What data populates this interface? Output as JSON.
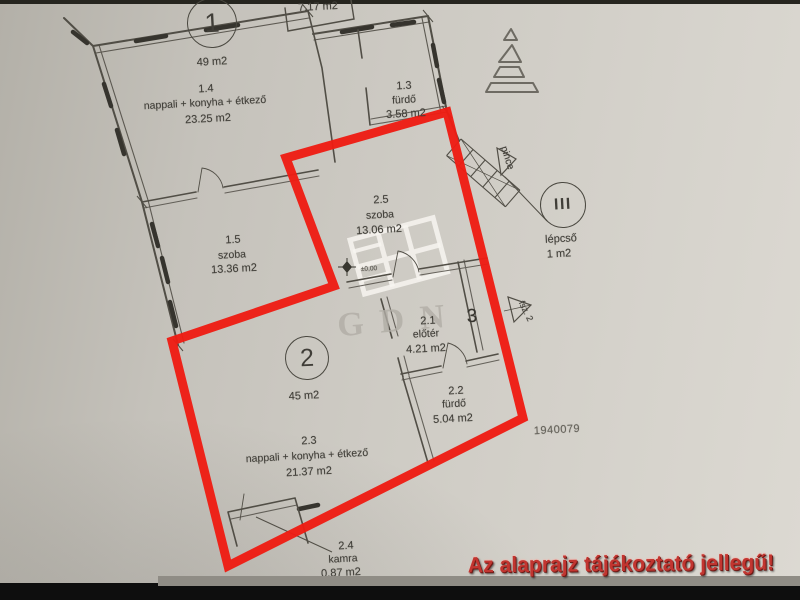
{
  "units": [
    {
      "number": "1",
      "total_area": "49 m2"
    },
    {
      "number": "2",
      "total_area": "45 m2"
    }
  ],
  "rooms": [
    {
      "id": "1.4",
      "name": "nappali + konyha + étkező",
      "area": "23.25 m2"
    },
    {
      "id": "1.3",
      "name": "fürdő",
      "area": "3.58 m2"
    },
    {
      "id": "1.5",
      "name": "szoba",
      "area": "13.36 m2"
    },
    {
      "id": "2.5",
      "name": "szoba",
      "area": "13.06 m2"
    },
    {
      "id": "2.1",
      "name": "előtér",
      "area": "4.21 m2"
    },
    {
      "id": "2.2",
      "name": "fürdő",
      "area": "5.04 m2"
    },
    {
      "id": "2.3",
      "name": "nappali + konyha + étkező",
      "area": "21.37 m2"
    },
    {
      "id": "2.4",
      "name": "kamra",
      "area": "0.87 m2"
    }
  ],
  "stairwell": {
    "symbol": "III",
    "name": "lépcső",
    "area": "1 m2"
  },
  "annotations": {
    "partial_area_top": "7.17 m2",
    "basement_label": "pince",
    "floor_marker": "fsz. 2",
    "position_number": "3",
    "elevation_marker": "±0,00",
    "plan_number": "1940079",
    "watermark": "GDN",
    "disclaimer": "Az alaprajz tájékoztató jellegű!"
  },
  "colors": {
    "highlight_red": "#ee1c13",
    "warning_text_red": "#c23530",
    "paper": "#cdcac3",
    "ink": "#514e46"
  }
}
